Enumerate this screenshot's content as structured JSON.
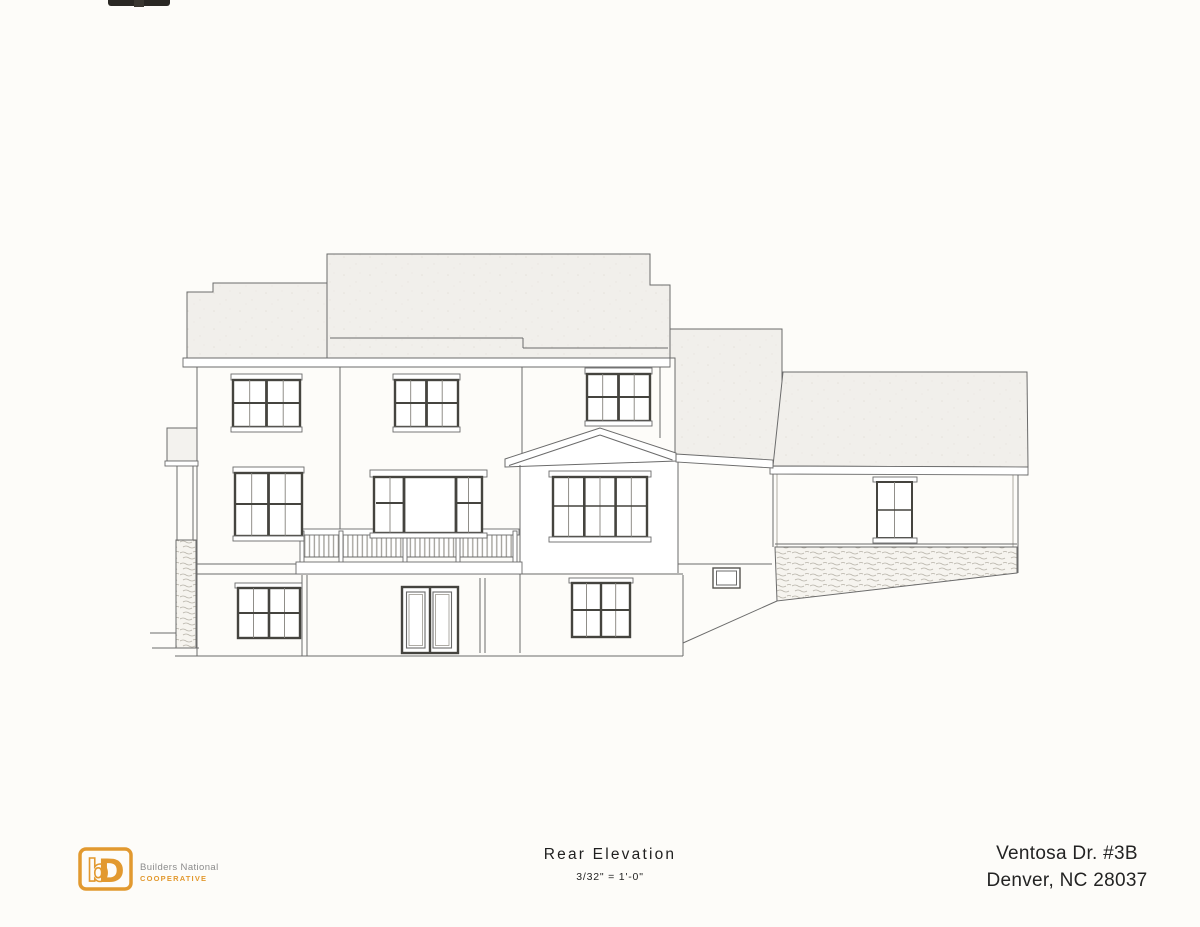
{
  "document": {
    "type_label": "Rear Elevation",
    "scale_label": "3/32\" = 1'-0\"",
    "address_line1": "Ventosa Dr. #3B",
    "address_line2": "Denver, NC 28037"
  },
  "logo": {
    "name_line1": "Builders National",
    "name_line2": "COOPERATIVE",
    "monogram_b": "b",
    "monogram_d": "D"
  },
  "drawing": {
    "alt": "Line drawing: rear elevation of a multi-level house with stepped roofs, attached right wing, center balcony deck with picket railing, walkout lower level with french doors, gabled bay with triple window, and stone accent band"
  },
  "colors": {
    "accent": "#E2992F",
    "paper": "#fdfcf9",
    "line": "#6b6b6b",
    "frame": "#45443f",
    "roof-base": "#f0eeea",
    "ink": "#262626",
    "brand-gray": "#8b8b8b"
  }
}
